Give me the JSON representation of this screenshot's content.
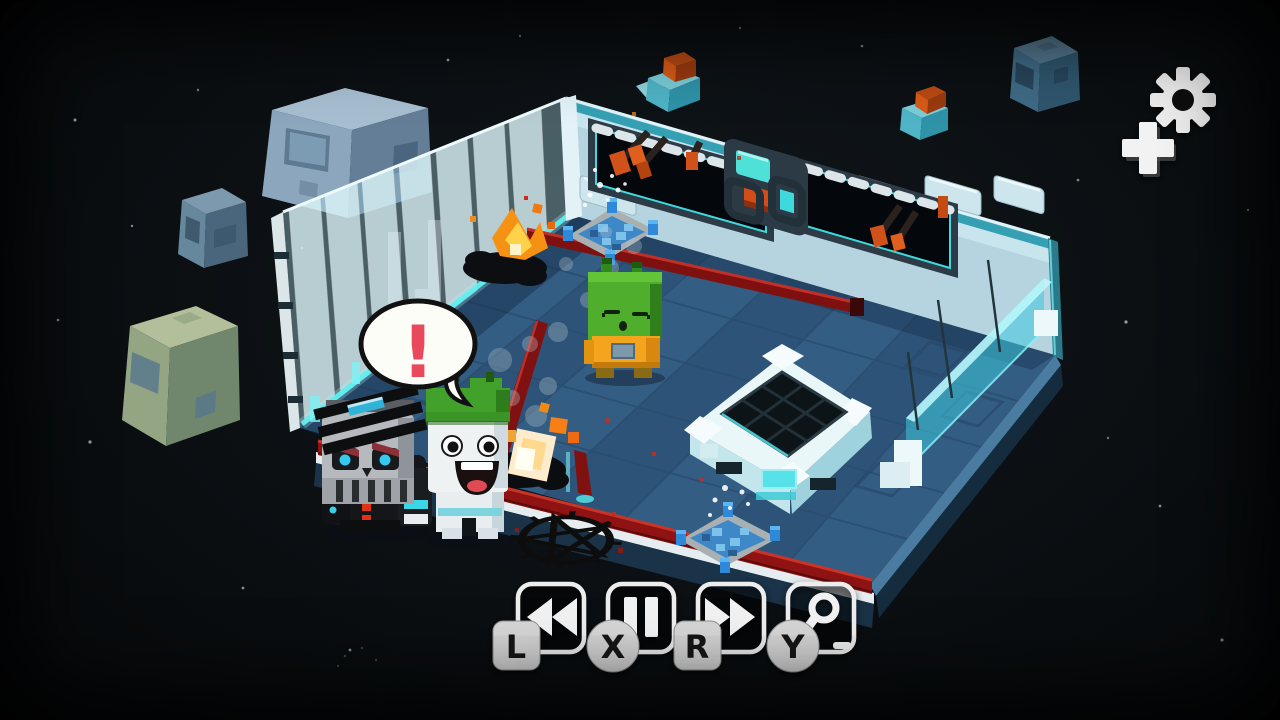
{
  "palette": {
    "space_bg": "#0b0f12",
    "floor_blue": "#345d83",
    "ice_wall": "#cfeef4",
    "cyan_glow": "#5ef0f0",
    "laser_red": "#8e1312",
    "laser_highlight": "#c63528",
    "hud_white": "#ededed",
    "badge_gray": "#d6d6d6",
    "alert_red": "#e8495c",
    "fire_orange": "#f59214",
    "killer_eye_blue": "#35c8f0"
  },
  "hud": {
    "settings_button": {
      "icon": "gear-icon"
    },
    "dpad_hint": {
      "icon": "plus-icon"
    },
    "controls": [
      {
        "id": "rewind",
        "icon": "rewind-icon",
        "badge": "L"
      },
      {
        "id": "pause",
        "icon": "pause-icon",
        "badge": "X"
      },
      {
        "id": "fast_forward",
        "icon": "fast-forward-icon",
        "badge": "R"
      },
      {
        "id": "zoom",
        "icon": "magnifier-minus-icon",
        "badge": "Y"
      }
    ]
  },
  "scene": {
    "speech_bubble": "!",
    "entities": [
      {
        "name": "skull-robot-killer"
      },
      {
        "name": "scared-survivor-green-cap"
      },
      {
        "name": "sleeping-alien-crew"
      },
      {
        "name": "burning-corpse",
        "count": 2
      },
      {
        "name": "pentagram-floor-decal"
      },
      {
        "name": "teleporter-pad"
      },
      {
        "name": "water-vent",
        "count": 2
      },
      {
        "name": "laser-fence",
        "count": 4
      },
      {
        "name": "floating-debris-cube",
        "count": 4
      }
    ]
  }
}
